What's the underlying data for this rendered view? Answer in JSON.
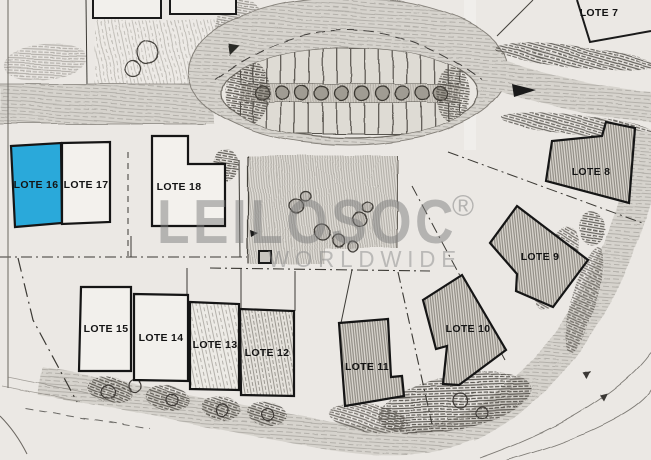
{
  "plan": {
    "title": "Urbanization site plan with numbered lots",
    "watermark": {
      "brand": "LEILOSOC",
      "registered": "®",
      "subtitle": "WORLDWIDE"
    },
    "highlight": {
      "lot": "LOTE 16",
      "color": "#2aa9da"
    },
    "colors": {
      "paper": "#ebe8e4",
      "ink": "#141414",
      "watermark": "#7f7f7f",
      "highlight": "#2aa9da"
    },
    "lots": [
      {
        "id": "lote-7",
        "label": "LOTE 7",
        "style": "outline-only"
      },
      {
        "id": "lote-8",
        "label": "LOTE 8",
        "style": "hatched"
      },
      {
        "id": "lote-9",
        "label": "LOTE 9",
        "style": "hatched"
      },
      {
        "id": "lote-10",
        "label": "LOTE 10",
        "style": "hatched"
      },
      {
        "id": "lote-11",
        "label": "LOTE 11",
        "style": "hatched"
      },
      {
        "id": "lote-12",
        "label": "LOTE 12",
        "style": "hatched-medium"
      },
      {
        "id": "lote-13",
        "label": "LOTE 13",
        "style": "hatched-light"
      },
      {
        "id": "lote-14",
        "label": "LOTE 14",
        "style": "white"
      },
      {
        "id": "lote-15",
        "label": "LOTE 15",
        "style": "white"
      },
      {
        "id": "lote-16",
        "label": "LOTE 16",
        "style": "highlighted"
      },
      {
        "id": "lote-17",
        "label": "LOTE 17",
        "style": "white"
      },
      {
        "id": "lote-18",
        "label": "LOTE 18",
        "style": "white"
      }
    ]
  }
}
